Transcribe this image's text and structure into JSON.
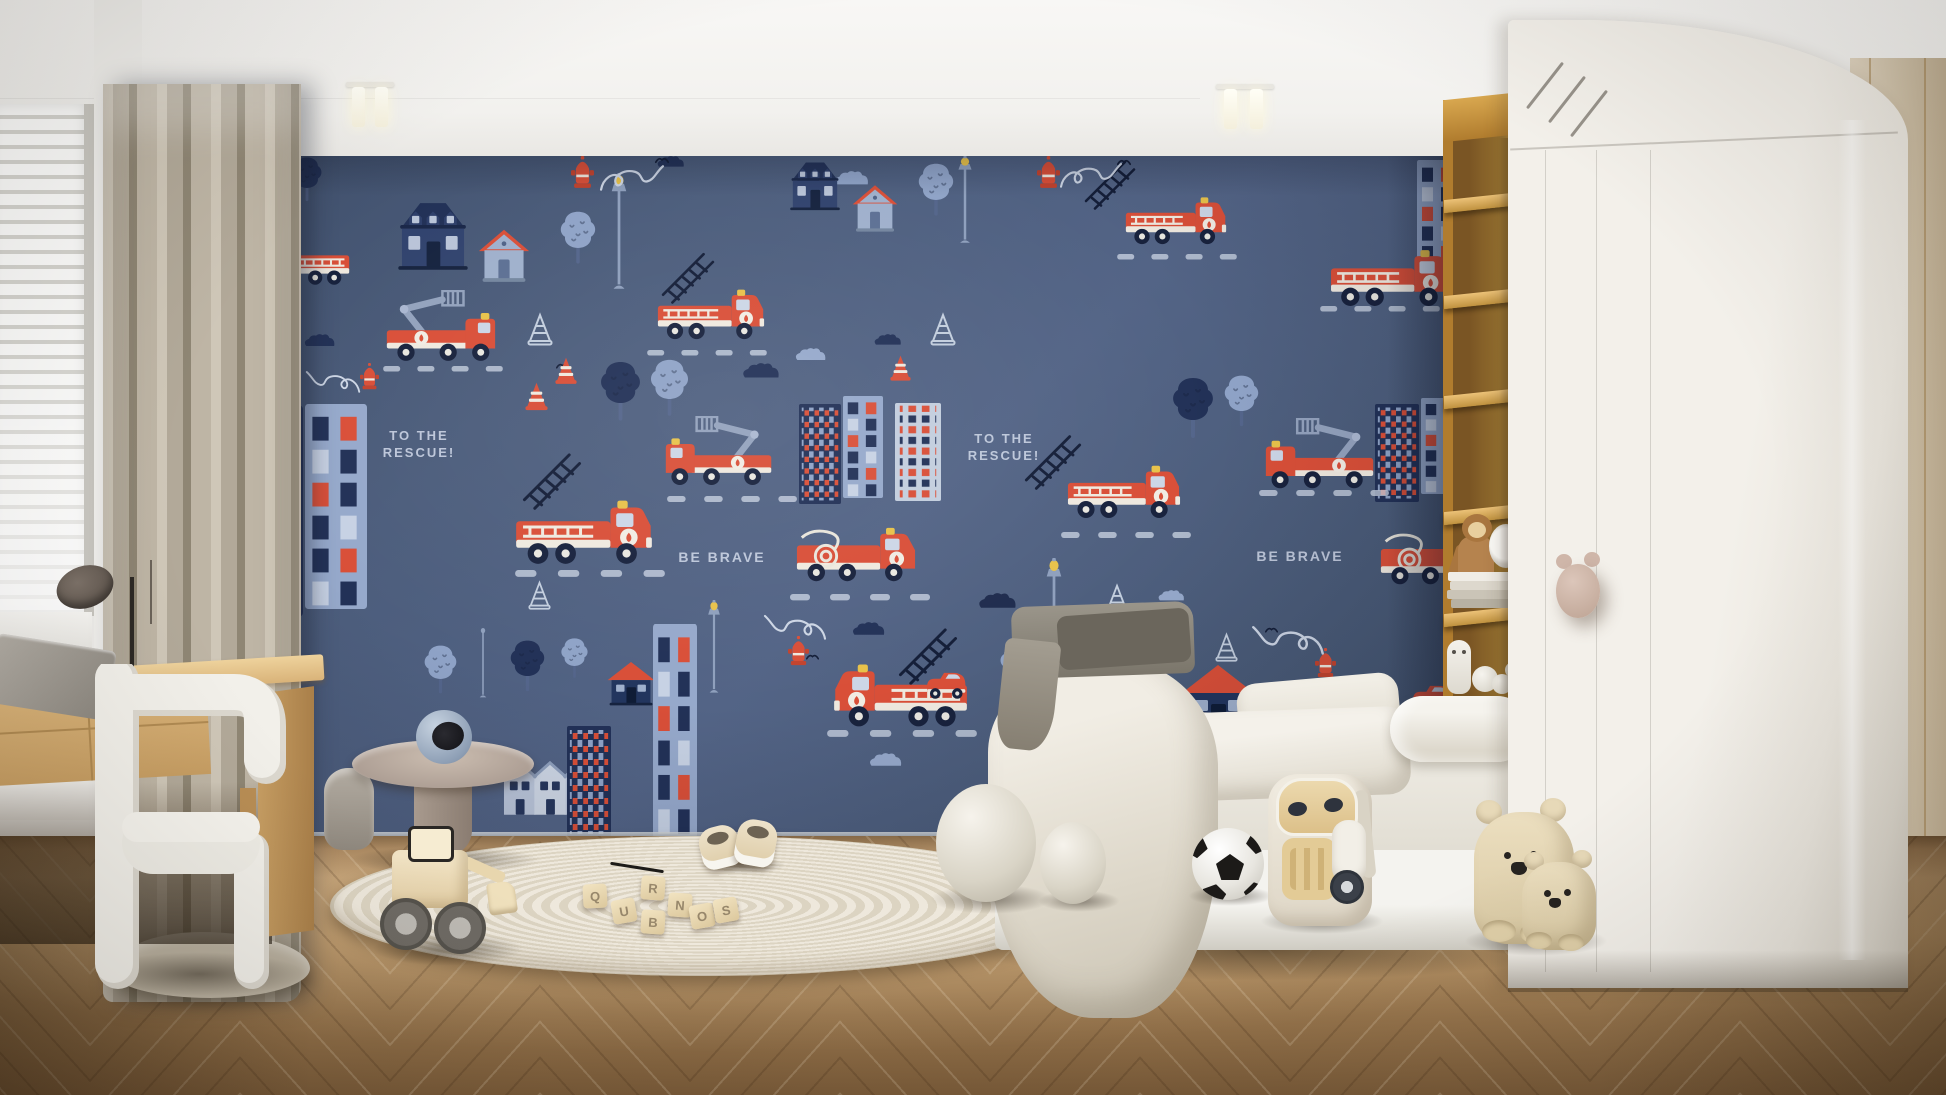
{
  "wallpaper": {
    "texts": [
      {
        "lines": [
          "TO THE",
          "RESCUE!"
        ],
        "x": 158,
        "y": 272,
        "w": 92,
        "size": 13
      },
      {
        "lines": [
          "TO THE",
          "RESCUE!"
        ],
        "x": 743,
        "y": 275,
        "w": 92,
        "size": 13
      },
      {
        "lines": [
          "BE BRAVE"
        ],
        "x": 445,
        "y": 392,
        "w": 124,
        "size": 14
      },
      {
        "lines": [
          "BE BRAVE"
        ],
        "x": 1023,
        "y": 391,
        "w": 124,
        "size": 14
      }
    ],
    "palette": {
      "background": "#4c5d7c",
      "red": "#d94f38",
      "navy": "#223157",
      "periwinkle": "#96a9cb",
      "pale": "#c3cede",
      "cream": "#efe9df",
      "yellow": "#e8c24a",
      "ink": "#141e38",
      "text": "#c7d0e2"
    },
    "motifs": [
      {
        "t": "cloud",
        "x": 526,
        "y": 207,
        "w": 42,
        "c": "#223157"
      },
      {
        "t": "cloud",
        "x": 579,
        "y": 192,
        "w": 35,
        "c": "#96a9cb"
      },
      {
        "t": "cloud",
        "x": 658,
        "y": 178,
        "w": 31,
        "c": "#223157"
      },
      {
        "t": "cloud",
        "x": 636,
        "y": 466,
        "w": 37,
        "c": "#223157"
      },
      {
        "t": "cloud",
        "x": 762,
        "y": 437,
        "w": 43,
        "c": "#1f2c4e"
      },
      {
        "t": "cloud",
        "x": 942,
        "y": 434,
        "w": 30,
        "c": "#96a9cb"
      },
      {
        "t": "cloud",
        "x": 653,
        "y": 597,
        "w": 37,
        "c": "#96a9cb"
      },
      {
        "t": "cloud",
        "x": 88,
        "y": 178,
        "w": 35,
        "c": "#223157"
      },
      {
        "t": "cloud",
        "x": 618,
        "y": 15,
        "w": 39,
        "c": "#8fa3c7"
      },
      {
        "t": "cloud",
        "x": 579,
        "y": 20,
        "w": 29,
        "c": "#223157"
      },
      {
        "t": "cloud",
        "x": 441,
        "y": 0,
        "w": 31,
        "c": "#223157"
      },
      {
        "t": "house-a",
        "x": 176,
        "y": 38,
        "w": 84
      },
      {
        "t": "house-b",
        "x": 262,
        "y": 70,
        "w": 54
      },
      {
        "t": "house-a",
        "x": 570,
        "y": 0,
        "w": 60
      },
      {
        "t": "house-b",
        "x": 636,
        "y": 26,
        "w": 48
      },
      {
        "t": "building-a",
        "x": 34,
        "y": 250,
        "w": 54,
        "h": 210
      },
      {
        "t": "building-b",
        "x": 90,
        "y": 248,
        "w": 62,
        "h": 205
      },
      {
        "t": "building-a",
        "x": 584,
        "y": 248,
        "w": 42,
        "h": 100
      },
      {
        "t": "building-b",
        "x": 628,
        "y": 240,
        "w": 40,
        "h": 102
      },
      {
        "t": "building-c",
        "x": 680,
        "y": 247,
        "w": 46,
        "h": 98
      },
      {
        "t": "house-c",
        "x": 966,
        "y": 506,
        "w": 74
      },
      {
        "t": "house-c",
        "x": 392,
        "y": 504,
        "w": 48
      },
      {
        "t": "building-b",
        "x": 438,
        "y": 468,
        "w": 44,
        "h": 214
      },
      {
        "t": "house-terrace",
        "x": 288,
        "y": 600,
        "w": 94
      },
      {
        "t": "building-a",
        "x": 352,
        "y": 570,
        "w": 44,
        "h": 112
      },
      {
        "t": "building-a",
        "x": 1160,
        "y": 248,
        "w": 44,
        "h": 98
      },
      {
        "t": "building-b",
        "x": 1206,
        "y": 242,
        "w": 40,
        "h": 96
      },
      {
        "t": "building-b",
        "x": 1202,
        "y": 4,
        "w": 42,
        "h": 122
      },
      {
        "t": "tree",
        "x": 344,
        "y": 54,
        "w": 38,
        "c": "#8fa3c7"
      },
      {
        "t": "tree",
        "x": 702,
        "y": 6,
        "w": 38,
        "c": "#8fa3c7"
      },
      {
        "t": "tree",
        "x": 384,
        "y": 204,
        "w": 43,
        "c": "#223157"
      },
      {
        "t": "tree",
        "x": 434,
        "y": 202,
        "w": 41,
        "c": "#8fa3c7"
      },
      {
        "t": "tree",
        "x": 208,
        "y": 488,
        "w": 35,
        "c": "#8fa3c7"
      },
      {
        "t": "tree",
        "x": 294,
        "y": 483,
        "w": 37,
        "c": "#223157"
      },
      {
        "t": "tree",
        "x": 345,
        "y": 481,
        "w": 29,
        "c": "#8fa3c7"
      },
      {
        "t": "tree",
        "x": 868,
        "y": 485,
        "w": 42,
        "c": "#223157"
      },
      {
        "t": "tree",
        "x": 920,
        "y": 483,
        "w": 36,
        "c": "#8fa3c7"
      },
      {
        "t": "tree",
        "x": 784,
        "y": 488,
        "w": 32,
        "c": "#8fa3c7"
      },
      {
        "t": "tree",
        "x": 956,
        "y": 220,
        "w": 44,
        "c": "#223157"
      },
      {
        "t": "tree",
        "x": 1008,
        "y": 218,
        "w": 37,
        "c": "#8fa3c7"
      },
      {
        "t": "tree",
        "x": 76,
        "y": 0,
        "w": 32,
        "c": "#223157"
      },
      {
        "t": "lamp",
        "x": 394,
        "y": 17,
        "w": 20,
        "h": 120
      },
      {
        "t": "lamp",
        "x": 741,
        "y": 0,
        "w": 18,
        "h": 90
      },
      {
        "t": "lamp",
        "x": 829,
        "y": 402,
        "w": 20,
        "h": 122
      },
      {
        "t": "lamp",
        "x": 491,
        "y": 444,
        "w": 16,
        "h": 96
      },
      {
        "t": "lamp-plain",
        "x": 262,
        "y": 470,
        "w": 12,
        "h": 74
      },
      {
        "t": "dash",
        "x": 168,
        "y": 210,
        "w": 120
      },
      {
        "t": "dash",
        "x": 300,
        "y": 414,
        "w": 150
      },
      {
        "t": "dash",
        "x": 452,
        "y": 340,
        "w": 130
      },
      {
        "t": "dash",
        "x": 575,
        "y": 438,
        "w": 140
      },
      {
        "t": "dash",
        "x": 612,
        "y": 574,
        "w": 150
      },
      {
        "t": "dash",
        "x": 432,
        "y": 194,
        "w": 120
      },
      {
        "t": "dash",
        "x": 902,
        "y": 98,
        "w": 120
      },
      {
        "t": "dash",
        "x": 1105,
        "y": 150,
        "w": 120
      },
      {
        "t": "dash",
        "x": 1044,
        "y": 334,
        "w": 130
      },
      {
        "t": "dash",
        "x": 846,
        "y": 376,
        "w": 130
      },
      {
        "t": "ladder",
        "x": 306,
        "y": 292,
        "w": 62
      },
      {
        "t": "ladder",
        "x": 682,
        "y": 467,
        "w": 62
      },
      {
        "t": "ladder",
        "x": 445,
        "y": 92,
        "w": 56
      },
      {
        "t": "ladder",
        "x": 868,
        "y": 0,
        "w": 54
      },
      {
        "t": "ladder",
        "x": 808,
        "y": 274,
        "w": 60
      },
      {
        "t": "hydrant",
        "x": 356,
        "y": 0,
        "w": 23
      },
      {
        "t": "squiggle",
        "x": 384,
        "y": 2,
        "w": 66,
        "c": "#cdd6e5"
      },
      {
        "t": "bird",
        "x": 440,
        "y": 0,
        "w": 14
      },
      {
        "t": "hydrant",
        "x": 822,
        "y": 0,
        "w": 23
      },
      {
        "t": "squiggle",
        "x": 844,
        "y": 0,
        "w": 64,
        "c": "#cdd6e5"
      },
      {
        "t": "bird",
        "x": 902,
        "y": 2,
        "w": 14
      },
      {
        "t": "hydrant",
        "x": 573,
        "y": 480,
        "w": 21
      },
      {
        "t": "squiggle",
        "x": 548,
        "y": 452,
        "w": 64,
        "c": "#cdd6e5",
        "f": 1
      },
      {
        "t": "bird",
        "x": 591,
        "y": 497,
        "w": 13
      },
      {
        "t": "hydrant",
        "x": 1100,
        "y": 492,
        "w": 21
      },
      {
        "t": "squiggle",
        "x": 1036,
        "y": 462,
        "w": 74,
        "c": "#cdd6e5",
        "f": 1
      },
      {
        "t": "bird",
        "x": 1050,
        "y": 470,
        "w": 13
      },
      {
        "t": "hydrant",
        "x": 145,
        "y": 207,
        "w": 19
      },
      {
        "t": "squiggle",
        "x": 90,
        "y": 209,
        "w": 56,
        "c": "#cdd6e5",
        "f": 1
      },
      {
        "t": "bird",
        "x": 341,
        "y": 206,
        "w": 13
      },
      {
        "t": "cone-o",
        "x": 312,
        "y": 156,
        "w": 26,
        "c": "#c3cede"
      },
      {
        "t": "cone-s",
        "x": 340,
        "y": 200,
        "w": 22
      },
      {
        "t": "cone-s",
        "x": 310,
        "y": 225,
        "w": 23
      },
      {
        "t": "cone-o",
        "x": 313,
        "y": 424,
        "w": 23,
        "c": "#c3cede"
      },
      {
        "t": "cone-o",
        "x": 890,
        "y": 427,
        "w": 24,
        "c": "#c3cede"
      },
      {
        "t": "cone-o",
        "x": 715,
        "y": 156,
        "w": 26,
        "c": "#c3cede"
      },
      {
        "t": "cone-s",
        "x": 675,
        "y": 198,
        "w": 21
      },
      {
        "t": "cone-o",
        "x": 1000,
        "y": 476,
        "w": 23,
        "c": "#c3cede"
      },
      {
        "t": "truck-ladder",
        "x": 40,
        "y": 82,
        "w": 95,
        "f": 1
      },
      {
        "t": "truck-crane",
        "x": 168,
        "y": 134,
        "w": 115,
        "f": 1
      },
      {
        "t": "truck-ladder",
        "x": 300,
        "y": 340,
        "w": 138
      },
      {
        "t": "truck-crane",
        "x": 448,
        "y": 260,
        "w": 112
      },
      {
        "t": "truck-hose",
        "x": 580,
        "y": 370,
        "w": 122
      },
      {
        "t": "truck-ladder",
        "x": 618,
        "y": 504,
        "w": 135,
        "f": 1
      },
      {
        "t": "car-small",
        "x": 710,
        "y": 514,
        "w": 44
      },
      {
        "t": "truck-ladder",
        "x": 442,
        "y": 130,
        "w": 108
      },
      {
        "t": "truck-ladder",
        "x": 910,
        "y": 38,
        "w": 102
      },
      {
        "t": "truck-ladder",
        "x": 1115,
        "y": 90,
        "w": 122
      },
      {
        "t": "truck-crane",
        "x": 1048,
        "y": 262,
        "w": 114
      },
      {
        "t": "truck-ladder",
        "x": 852,
        "y": 306,
        "w": 114
      },
      {
        "t": "truck-hose",
        "x": 1164,
        "y": 374,
        "w": 120
      },
      {
        "t": "car-small",
        "x": 1196,
        "y": 527,
        "w": 44
      }
    ]
  },
  "toy_blocks": [
    {
      "ch": "Q",
      "x": 583,
      "y": 884
    },
    {
      "ch": "U",
      "x": 612,
      "y": 899
    },
    {
      "ch": "B",
      "x": 641,
      "y": 910
    },
    {
      "ch": "N",
      "x": 668,
      "y": 893
    },
    {
      "ch": "O",
      "x": 690,
      "y": 904
    },
    {
      "ch": "R",
      "x": 641,
      "y": 876
    },
    {
      "ch": "S",
      "x": 714,
      "y": 898
    }
  ],
  "room_colors": {
    "ceiling": "#f2f1ee",
    "curtain": "#b2a999",
    "desk_wood": "#d9b379",
    "floor_light": "#c19e72",
    "floor_dark": "#7a5b39",
    "rug": "#e9e3d6",
    "bedding": "#f1ede4",
    "shelf_wood": "#b98a3c",
    "wardrobe": "#f0ede7",
    "wardrobe_handle": "#c9aea2",
    "right_wall": "#cfc1a8"
  }
}
